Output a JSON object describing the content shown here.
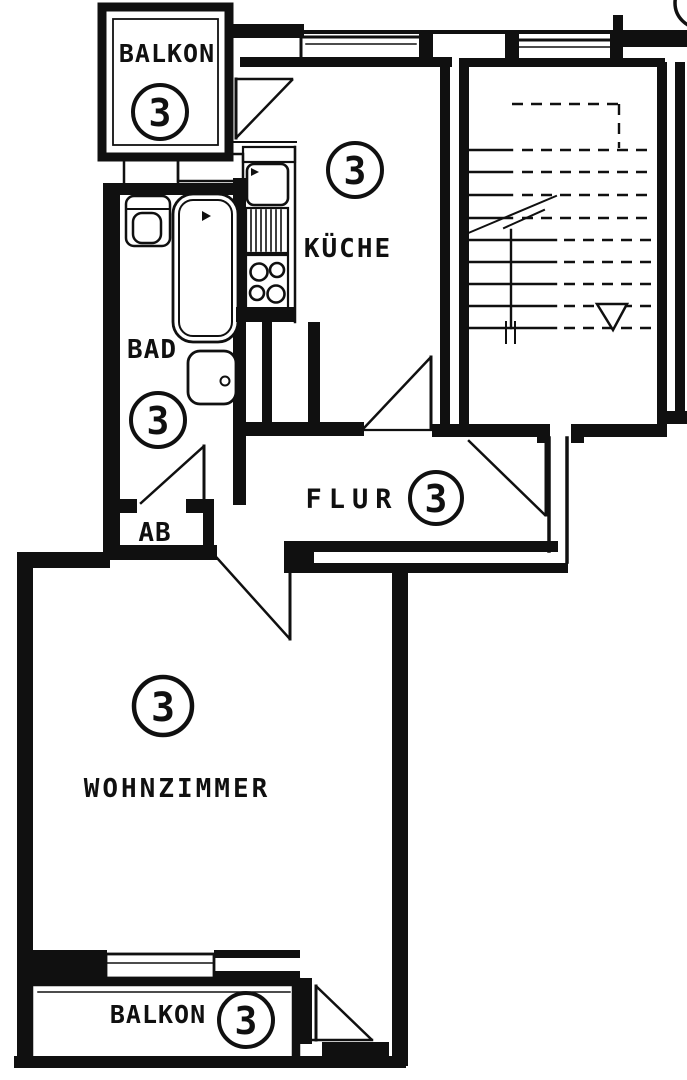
{
  "document": {
    "kind": "apartment floor plan (scanned line drawing)",
    "unit_number": "3"
  },
  "colors": {
    "ink": "#101010",
    "paper": "#ffffff"
  },
  "rooms": {
    "balkon_top": {
      "label": "BALKON",
      "number": "3"
    },
    "kueche": {
      "label": "KÜCHE",
      "number": "3"
    },
    "bad": {
      "label": "BAD",
      "number": "3"
    },
    "flur": {
      "label": "FLUR",
      "number": "3"
    },
    "ab": {
      "label": "AB"
    },
    "wohnzimmer": {
      "label": "WOHNZIMMER",
      "number": "3"
    },
    "balkon_bottom": {
      "label": "BALKON",
      "number": "3"
    }
  },
  "fixtures": {
    "bad": [
      "toilet",
      "bathtub",
      "washbasin"
    ],
    "kueche": [
      "kitchen-sink",
      "worktop-drainer",
      "stove-4-burners"
    ]
  },
  "stairwell": {
    "stairs_style": "solid treads lower flight, dashed treads upper flight, break line",
    "direction_arrow": "down"
  }
}
